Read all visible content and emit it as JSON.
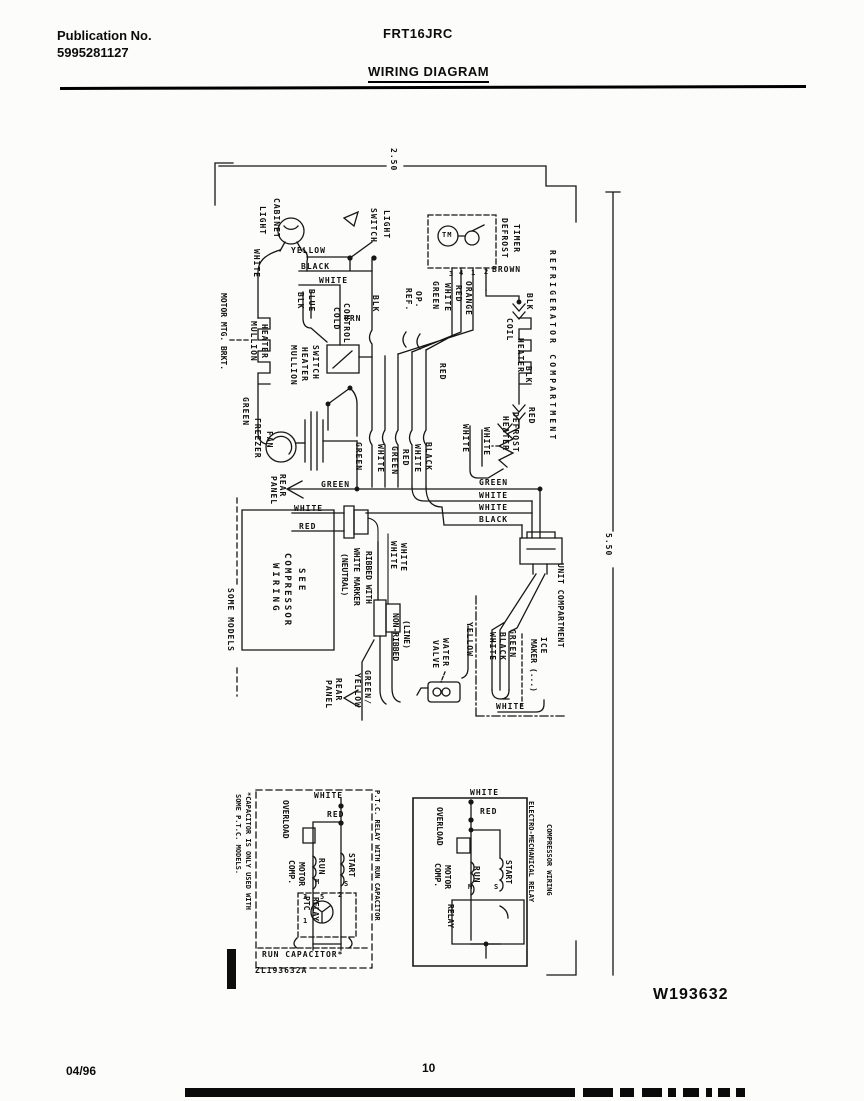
{
  "header": {
    "publication_label": "Publication No.",
    "publication_number": "5995281127",
    "model": "FRT16JRC",
    "title": "WIRING DIAGRAM"
  },
  "footer": {
    "date": "04/96",
    "page": "10",
    "drawing_number": "W193632"
  },
  "diagram": {
    "labels": [
      {
        "t": "2.50",
        "x": 389,
        "y": 148,
        "d": "v"
      },
      {
        "t": "5.50",
        "x": 604,
        "y": 533,
        "d": "v"
      },
      {
        "t": "CABINET",
        "x": 272,
        "y": 198,
        "d": "v"
      },
      {
        "t": "LIGHT",
        "x": 258,
        "y": 206,
        "d": "v"
      },
      {
        "t": "WHITE",
        "x": 252,
        "y": 249,
        "d": "v"
      },
      {
        "t": "LIGHT",
        "x": 382,
        "y": 210,
        "d": "v"
      },
      {
        "t": "SWITCH",
        "x": 369,
        "y": 208,
        "d": "v"
      },
      {
        "t": "DEFROST",
        "x": 500,
        "y": 218,
        "d": "v"
      },
      {
        "t": "TIMER",
        "x": 512,
        "y": 224,
        "d": "v"
      },
      {
        "t": "TM",
        "x": 442,
        "y": 232,
        "d": "h",
        "fs": 7
      },
      {
        "t": "3",
        "x": 449,
        "y": 271,
        "d": "h",
        "fs": 7
      },
      {
        "t": "4",
        "x": 459,
        "y": 270,
        "d": "h",
        "fs": 7
      },
      {
        "t": "1",
        "x": 471,
        "y": 270,
        "d": "h",
        "fs": 7
      },
      {
        "t": "2",
        "x": 484,
        "y": 269,
        "d": "h",
        "fs": 7
      },
      {
        "t": "GREEN",
        "x": 431,
        "y": 281,
        "d": "v"
      },
      {
        "t": "WHITE",
        "x": 443,
        "y": 283,
        "d": "v"
      },
      {
        "t": "RED",
        "x": 454,
        "y": 285,
        "d": "v"
      },
      {
        "t": "ORANGE",
        "x": 464,
        "y": 281,
        "d": "v"
      },
      {
        "t": "BROWN",
        "x": 492,
        "y": 266,
        "d": "h"
      },
      {
        "t": "BLK",
        "x": 525,
        "y": 293,
        "d": "v"
      },
      {
        "t": "COIL",
        "x": 505,
        "y": 318,
        "d": "v"
      },
      {
        "t": "HEATER",
        "x": 516,
        "y": 338,
        "d": "v"
      },
      {
        "t": "BLK",
        "x": 524,
        "y": 366,
        "d": "v"
      },
      {
        "t": "RED",
        "x": 527,
        "y": 407,
        "d": "v"
      },
      {
        "t": "REFRIGERATOR COMPARTMENT",
        "x": 548,
        "y": 250,
        "d": "v",
        "ls": 3.2
      },
      {
        "t": "MOTOR MTG. BRKT.",
        "x": 219,
        "y": 293,
        "d": "v",
        "ls": 0
      },
      {
        "t": "MULLION",
        "x": 249,
        "y": 321,
        "d": "v"
      },
      {
        "t": "HEATER",
        "x": 260,
        "y": 324,
        "d": "v"
      },
      {
        "t": "YELLOW",
        "x": 291,
        "y": 247,
        "d": "h"
      },
      {
        "t": "BLACK",
        "x": 301,
        "y": 263,
        "d": "h"
      },
      {
        "t": "WHITE",
        "x": 319,
        "y": 277,
        "d": "h"
      },
      {
        "t": "BLK",
        "x": 296,
        "y": 292,
        "d": "v"
      },
      {
        "t": "BLUE",
        "x": 307,
        "y": 289,
        "d": "v"
      },
      {
        "t": "COLD",
        "x": 332,
        "y": 307,
        "d": "v"
      },
      {
        "t": "CONTROL",
        "x": 342,
        "y": 303,
        "d": "v"
      },
      {
        "t": "ORN",
        "x": 344,
        "y": 315,
        "d": "h"
      },
      {
        "t": "MULLION",
        "x": 289,
        "y": 345,
        "d": "v"
      },
      {
        "t": "HEATER",
        "x": 300,
        "y": 347,
        "d": "v"
      },
      {
        "t": "SWITCH",
        "x": 311,
        "y": 345,
        "d": "v"
      },
      {
        "t": "BLK",
        "x": 371,
        "y": 295,
        "d": "v"
      },
      {
        "t": "REF.",
        "x": 404,
        "y": 288,
        "d": "v"
      },
      {
        "t": "OP.",
        "x": 414,
        "y": 291,
        "d": "v"
      },
      {
        "t": "RED",
        "x": 438,
        "y": 363,
        "d": "v"
      },
      {
        "t": "GREEN",
        "x": 241,
        "y": 397,
        "d": "v"
      },
      {
        "t": "FREEZER",
        "x": 253,
        "y": 418,
        "d": "v"
      },
      {
        "t": "FAN",
        "x": 265,
        "y": 431,
        "d": "v"
      },
      {
        "t": "GREEN",
        "x": 354,
        "y": 442,
        "d": "v"
      },
      {
        "t": "WHITE",
        "x": 376,
        "y": 444,
        "d": "v"
      },
      {
        "t": "GREEN",
        "x": 390,
        "y": 446,
        "d": "v"
      },
      {
        "t": "RED",
        "x": 401,
        "y": 449,
        "d": "v"
      },
      {
        "t": "WHITE",
        "x": 413,
        "y": 444,
        "d": "v"
      },
      {
        "t": "BLACK",
        "x": 424,
        "y": 442,
        "d": "v"
      },
      {
        "t": "WHITE",
        "x": 461,
        "y": 424,
        "d": "v"
      },
      {
        "t": "WHITE",
        "x": 482,
        "y": 427,
        "d": "v"
      },
      {
        "t": "HEATER",
        "x": 501,
        "y": 416,
        "d": "v"
      },
      {
        "t": "DEFROST",
        "x": 511,
        "y": 412,
        "d": "v"
      },
      {
        "t": "GREEN",
        "x": 479,
        "y": 479,
        "d": "h"
      },
      {
        "t": "WHITE",
        "x": 479,
        "y": 492,
        "d": "h"
      },
      {
        "t": "WHITE",
        "x": 479,
        "y": 504,
        "d": "h"
      },
      {
        "t": "BLACK",
        "x": 479,
        "y": 516,
        "d": "h"
      },
      {
        "t": "GREEN",
        "x": 321,
        "y": 481,
        "d": "h"
      },
      {
        "t": "REAR",
        "x": 278,
        "y": 474,
        "d": "v"
      },
      {
        "t": "PANEL",
        "x": 269,
        "y": 476,
        "d": "v"
      },
      {
        "t": "WHITE",
        "x": 294,
        "y": 505,
        "d": "h"
      },
      {
        "t": "RED",
        "x": 299,
        "y": 523,
        "d": "h"
      },
      {
        "t": "SEE",
        "x": 296,
        "y": 568,
        "d": "v",
        "fs": 9,
        "ls": 3
      },
      {
        "t": "COMPRESSOR",
        "x": 282,
        "y": 553,
        "d": "v",
        "fs": 9,
        "ls": 2
      },
      {
        "t": "WIRING",
        "x": 270,
        "y": 563,
        "d": "v",
        "fs": 9,
        "ls": 3
      },
      {
        "t": "SOME MODELS",
        "x": 226,
        "y": 588,
        "d": "v"
      },
      {
        "t": "RIBBED WITH",
        "x": 364,
        "y": 551,
        "d": "v",
        "ls": 0
      },
      {
        "t": "WHITE MARKER",
        "x": 352,
        "y": 548,
        "d": "v",
        "ls": 0
      },
      {
        "t": "(NEUTRAL)",
        "x": 340,
        "y": 553,
        "d": "v",
        "ls": 0
      },
      {
        "t": "WHITE",
        "x": 389,
        "y": 541,
        "d": "v"
      },
      {
        "t": "WHITE",
        "x": 399,
        "y": 543,
        "d": "v"
      },
      {
        "t": "NON-RIBBED",
        "x": 391,
        "y": 613,
        "d": "v",
        "ls": 0
      },
      {
        "t": "(LINE)",
        "x": 402,
        "y": 620,
        "d": "v",
        "ls": 0
      },
      {
        "t": "REAR",
        "x": 334,
        "y": 678,
        "d": "v"
      },
      {
        "t": "PANEL",
        "x": 324,
        "y": 680,
        "d": "v"
      },
      {
        "t": "GREEN/",
        "x": 363,
        "y": 670,
        "d": "v"
      },
      {
        "t": "YELLOW",
        "x": 353,
        "y": 673,
        "d": "v"
      },
      {
        "t": "UNIT COMPARTMENT",
        "x": 556,
        "y": 563,
        "d": "v",
        "ls": 0.5
      },
      {
        "t": "ICE",
        "x": 539,
        "y": 637,
        "d": "v"
      },
      {
        "t": "MAKER (...)",
        "x": 529,
        "y": 639,
        "d": "v",
        "ls": 0
      },
      {
        "t": "GREEN",
        "x": 508,
        "y": 629,
        "d": "v"
      },
      {
        "t": "BLACK",
        "x": 498,
        "y": 632,
        "d": "v"
      },
      {
        "t": "WHITE",
        "x": 488,
        "y": 632,
        "d": "v"
      },
      {
        "t": "YELLOW",
        "x": 465,
        "y": 622,
        "d": "v"
      },
      {
        "t": "WATER",
        "x": 441,
        "y": 638,
        "d": "v"
      },
      {
        "t": "VALVE",
        "x": 431,
        "y": 640,
        "d": "v"
      },
      {
        "t": "WHITE",
        "x": 496,
        "y": 703,
        "d": "h"
      },
      {
        "t": "P.T.C. RELAY WITH RUN CAPACITOR",
        "x": 373,
        "y": 790,
        "d": "v",
        "fs": 7,
        "ls": 0
      },
      {
        "t": "*CAPACITOR IS ONLY USED WITH",
        "x": 244,
        "y": 792,
        "d": "v",
        "fs": 7,
        "ls": 0
      },
      {
        "t": "SOME P.T.C. MODELS.",
        "x": 234,
        "y": 794,
        "d": "v",
        "fs": 7,
        "ls": 0
      },
      {
        "t": "WHITE",
        "x": 314,
        "y": 792,
        "d": "h"
      },
      {
        "t": "RED",
        "x": 327,
        "y": 811,
        "d": "h"
      },
      {
        "t": "OVERLOAD",
        "x": 281,
        "y": 800,
        "d": "v",
        "ls": 0
      },
      {
        "t": "COMP.",
        "x": 287,
        "y": 860,
        "d": "v",
        "ls": 0
      },
      {
        "t": "MOTOR",
        "x": 297,
        "y": 862,
        "d": "v",
        "ls": 0
      },
      {
        "t": "RUN",
        "x": 317,
        "y": 858,
        "d": "v"
      },
      {
        "t": "START",
        "x": 347,
        "y": 853,
        "d": "v",
        "ls": 0
      },
      {
        "t": "PTC",
        "x": 302,
        "y": 896,
        "d": "v",
        "ls": 0
      },
      {
        "t": "RELAY",
        "x": 311,
        "y": 897,
        "d": "v",
        "ls": 0
      },
      {
        "t": "M",
        "x": 315,
        "y": 879,
        "d": "h",
        "fs": 7
      },
      {
        "t": "S",
        "x": 344,
        "y": 881,
        "d": "h",
        "fs": 7
      },
      {
        "t": "3",
        "x": 303,
        "y": 894,
        "d": "h",
        "fs": 7
      },
      {
        "t": "5",
        "x": 320,
        "y": 894,
        "d": "h",
        "fs": 7
      },
      {
        "t": "2",
        "x": 338,
        "y": 892,
        "d": "h",
        "fs": 7
      },
      {
        "t": "1",
        "x": 303,
        "y": 918,
        "d": "h",
        "fs": 7
      },
      {
        "t": "RUN CAPACITOR*",
        "x": 262,
        "y": 951,
        "d": "h"
      },
      {
        "t": "ZL193632A",
        "x": 255,
        "y": 967,
        "d": "h"
      },
      {
        "t": "ELECTRO-MECHANICAL RELAY",
        "x": 527,
        "y": 801,
        "d": "v",
        "fs": 7,
        "ls": 0
      },
      {
        "t": "COMPRESSOR WIRING",
        "x": 545,
        "y": 824,
        "d": "v",
        "fs": 7,
        "ls": 0
      },
      {
        "t": "WHITE",
        "x": 470,
        "y": 789,
        "d": "h"
      },
      {
        "t": "RED",
        "x": 480,
        "y": 808,
        "d": "h"
      },
      {
        "t": "OVERLOAD",
        "x": 435,
        "y": 807,
        "d": "v",
        "ls": 0
      },
      {
        "t": "COMP.",
        "x": 433,
        "y": 863,
        "d": "v",
        "ls": 0
      },
      {
        "t": "MOTOR",
        "x": 443,
        "y": 865,
        "d": "v",
        "ls": 0
      },
      {
        "t": "RUN",
        "x": 472,
        "y": 866,
        "d": "v"
      },
      {
        "t": "START",
        "x": 504,
        "y": 860,
        "d": "v",
        "ls": 0
      },
      {
        "t": "RELAY",
        "x": 446,
        "y": 904,
        "d": "v",
        "ls": 0
      },
      {
        "t": "M",
        "x": 468,
        "y": 884,
        "d": "h",
        "fs": 7
      },
      {
        "t": "S",
        "x": 494,
        "y": 884,
        "d": "h",
        "fs": 7
      }
    ]
  }
}
